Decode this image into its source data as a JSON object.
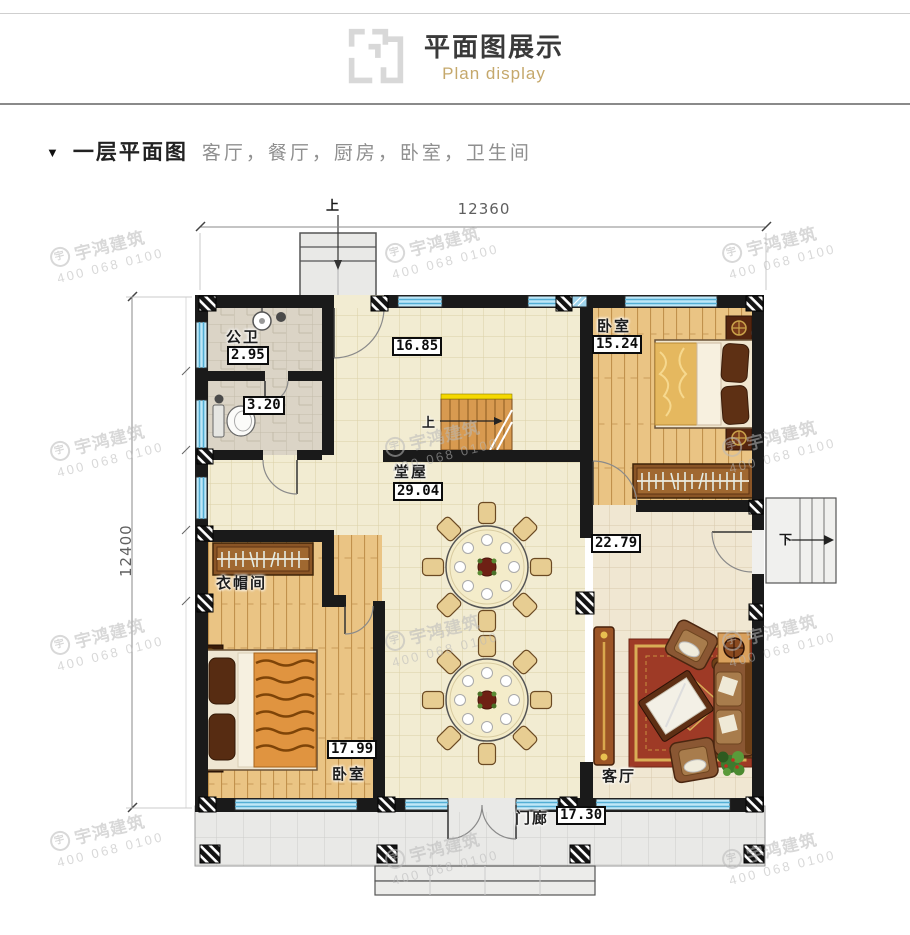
{
  "header": {
    "title": "平面图展示",
    "subtitle": "Plan display"
  },
  "section": {
    "marker": "▼",
    "title": "一层平面图",
    "rooms_list": "客厅，餐厅，厨房，卧室，卫生间"
  },
  "plan": {
    "dim_width": "12360",
    "dim_height": "12400",
    "up_label": "上",
    "stairs_up_label": "上",
    "down_label": "下",
    "rooms": {
      "bath": {
        "name": "公卫",
        "area": "2.95"
      },
      "toilet": {
        "area": "3.20"
      },
      "dining": {
        "area": "16.85"
      },
      "bedroom_right": {
        "name": "卧室",
        "area": "15.24"
      },
      "hall": {
        "name": "堂屋",
        "area": "29.04"
      },
      "family": {
        "area": "22.79"
      },
      "cloakroom": {
        "name": "衣帽间"
      },
      "bedroom_left": {
        "name": "卧室",
        "area": "17.99"
      },
      "living": {
        "name": "客厅"
      },
      "porch": {
        "name": "门廊",
        "area": "17.30"
      }
    },
    "watermark": {
      "logo": "宇",
      "brand": "宇鸿建筑",
      "phone": "400 068 0100"
    },
    "colors": {
      "wall": "#1a1a1a",
      "window": "#bfe7f7",
      "accent_gold": "#c5a86b"
    }
  }
}
